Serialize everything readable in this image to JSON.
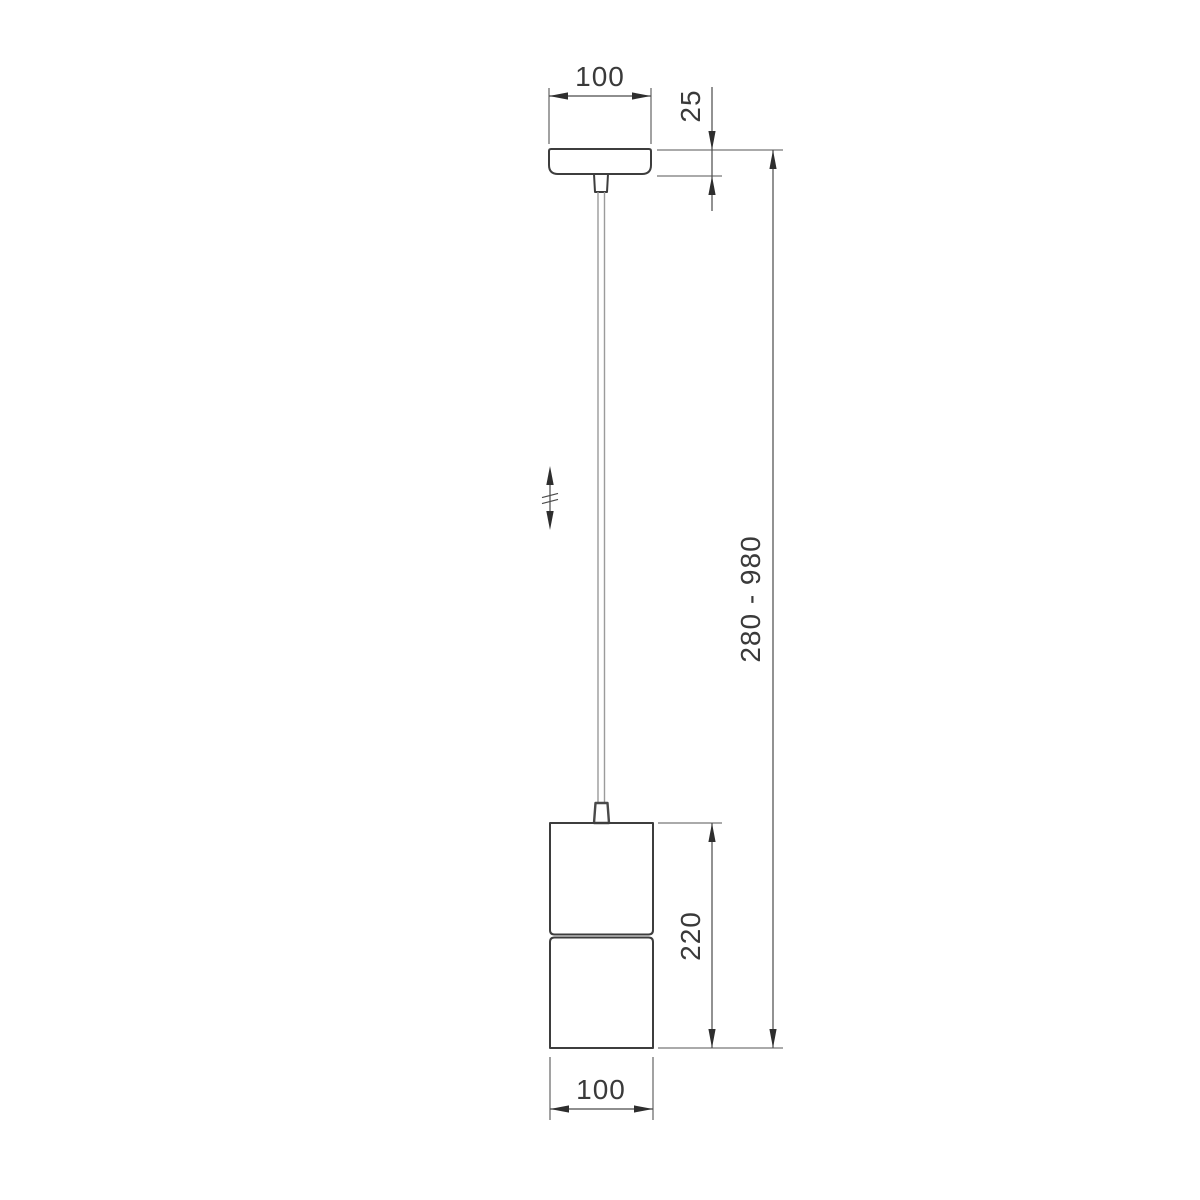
{
  "drawing": {
    "labels": {
      "canopy_width": "100",
      "canopy_height": "25",
      "suspension_range": "280 - 980",
      "body_height": "220",
      "body_width": "100"
    },
    "colors": {
      "object_line": "#3d3d3d",
      "dimension_line": "#4a4a4a",
      "cable": "#9b9b9b",
      "text": "#3a3a3a",
      "background": "#ffffff"
    }
  }
}
